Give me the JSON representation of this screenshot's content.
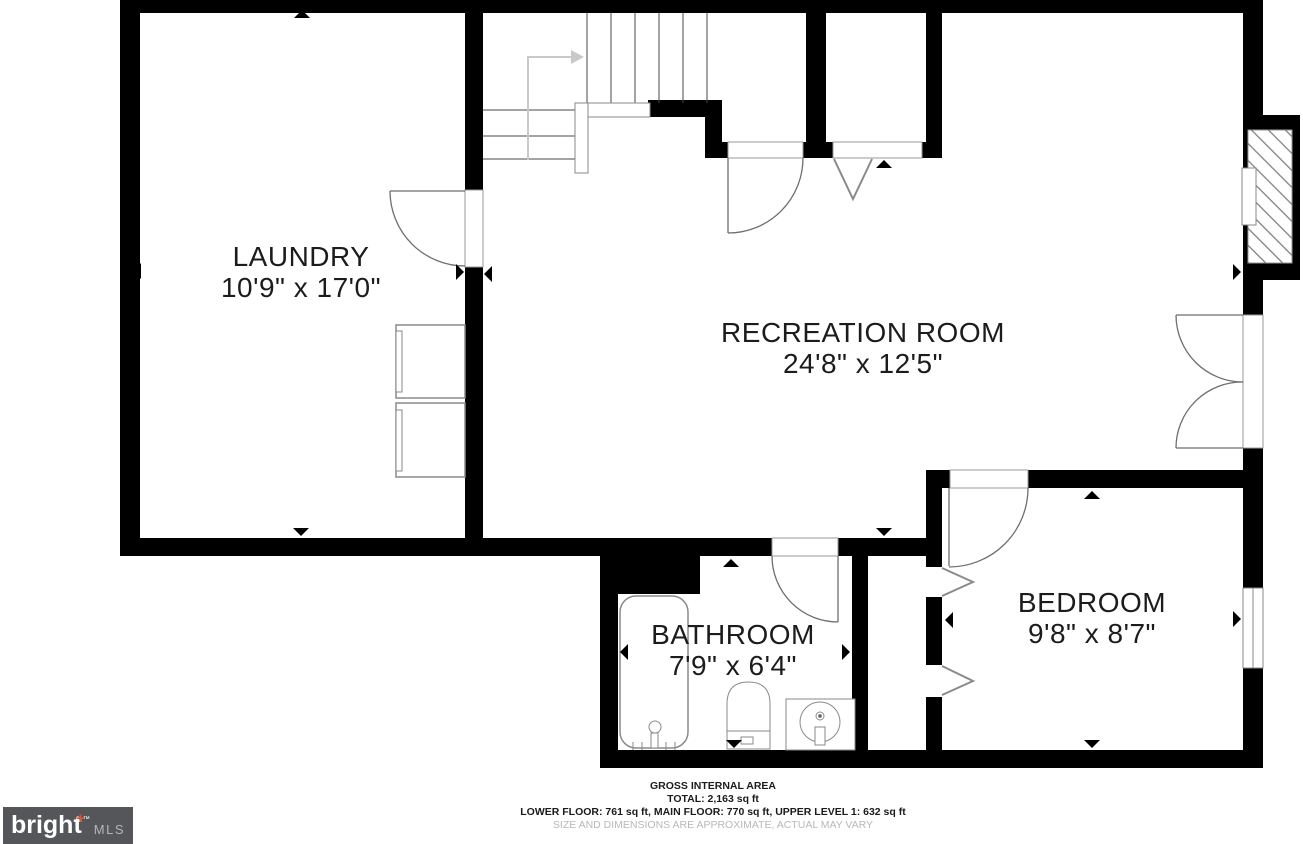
{
  "plan": {
    "rooms": [
      {
        "name": "LAUNDRY",
        "dimensions": "10'9\" x 17'0\""
      },
      {
        "name": "RECREATION ROOM",
        "dimensions": "24'8\" x 12'5\""
      },
      {
        "name": "BATHROOM",
        "dimensions": "7'9\" x 6'4\""
      },
      {
        "name": "BEDROOM",
        "dimensions": "9'8\" x 8'7\""
      }
    ],
    "fixtures": [
      "staircase",
      "stair-direction-arrow",
      "fireplace",
      "double-door",
      "bedroom-window",
      "washer",
      "dryer",
      "bathtub",
      "toilet",
      "sink",
      "hinged-doors",
      "bifold-doors",
      "dimension-markers"
    ]
  },
  "footer": {
    "title": "GROSS INTERNAL AREA",
    "total": "TOTAL: 2,163 sq ft",
    "breakdown": "LOWER FLOOR: 761 sq ft, MAIN FLOOR: 770 sq ft, UPPER LEVEL 1: 632 sq ft",
    "disclaimer": "SIZE AND DIMENSIONS ARE APPROXIMATE, ACTUAL MAY VARY"
  },
  "logo": {
    "brand": "bright",
    "trademark": "™",
    "suffix": "MLS"
  },
  "colors": {
    "wall": "#000000",
    "fixture_stroke": "#8a8a8a",
    "label_text": "#1c1c1c",
    "disclaimer_text": "#b8b8b8",
    "logo_background": "#55565a",
    "logo_text": "#ffffff",
    "logo_mls_text": "#b4b6b9",
    "logo_accent": "#e0552c",
    "stair_arrow": "#c9c9c9"
  }
}
